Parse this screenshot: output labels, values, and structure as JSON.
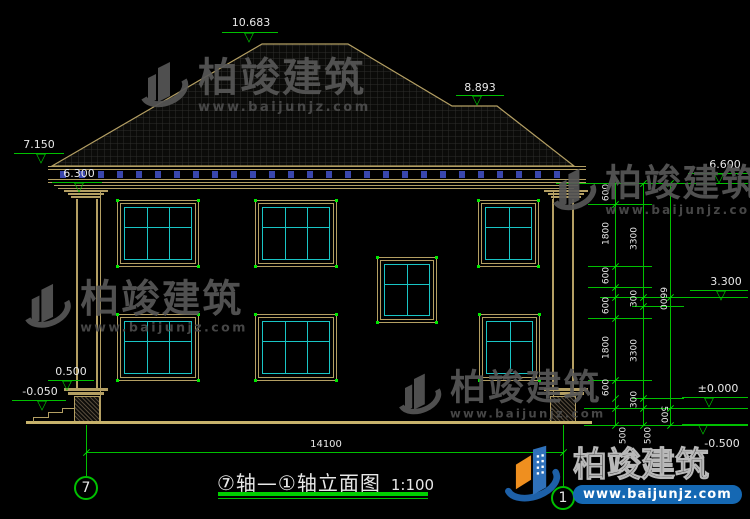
{
  "drawing": {
    "title": "⑦轴—①轴立面图",
    "scale": "1:100",
    "axis_bubbles": {
      "left": "7",
      "right": "1"
    }
  },
  "elevation_markers": {
    "ridge": "10.683",
    "right_ridge": "8.893",
    "left_eave": "7.150",
    "left_capital": "6.300",
    "plinth_top": "0.500",
    "terrace": "-0.050",
    "right_top": "6.600",
    "right_mid": "3.300",
    "right_zero": "±0.000",
    "right_ground": "-0.500"
  },
  "dims": {
    "inner": [
      "600",
      "1800",
      "600",
      "600",
      "1800",
      "600"
    ],
    "inner_bottom": "500",
    "middle": [
      "3300",
      "300",
      "3300",
      "300"
    ],
    "middle_bottom": "500",
    "outer_total": "6600",
    "outer_bottom": "500",
    "total_width": "14100"
  },
  "watermark": {
    "name": "柏竣建筑",
    "url": "www.baijunjz.com"
  },
  "brand": {
    "name": "柏竣建筑",
    "url": "www.baijunjz.com"
  },
  "colors": {
    "background": "#000000",
    "dimension_green": "#00c000",
    "line_tan": "#b49f63",
    "window_cyan": "#19c5c5",
    "dentil_blue": "#3946ad",
    "brand_blue": "#1d60a8",
    "brand_orange": "#ef8f1f",
    "text_white": "#e8e8e8"
  }
}
